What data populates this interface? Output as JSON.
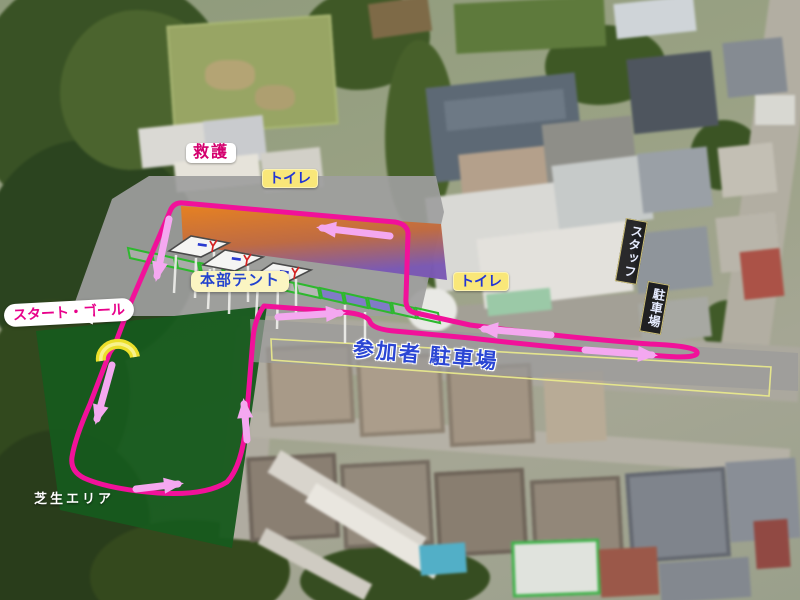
{
  "map": {
    "labels": {
      "first_aid": "救護",
      "toilet_north": "トイレ",
      "hq_tent": "本部テント",
      "toilet_school": "トイレ",
      "start_goal": "スタート・ゴール",
      "staff_parking_upper": "スタッフ",
      "staff_parking_lower": "駐車場",
      "participant_parking": "参加者 駐車場",
      "lawn_area": "芝生エリア"
    },
    "icons": {
      "start_goal_gate": "arch-gate-icon",
      "course_route": "course-route-line",
      "direction_arrow": "direction-arrow-icon",
      "hq_tents": "tent-icon"
    },
    "colors": {
      "course_line": "#f1119a",
      "direction_arrow": "#f4a8f0",
      "gate_yellow": "#ecdf2a",
      "lawn_green": "#175a1d",
      "overlay_gray": "#9e9e9e",
      "tent_zone_orange": "#e8801e",
      "tent_zone_purple": "#7a58b4",
      "parking_outline_yellow": "#e8e88c",
      "participant_text_blue": "#2b46d4",
      "label_magenta_text": "#e8008a",
      "toilet_label_bg": "#f9e779",
      "hq_label_bg": "#fbf5c2",
      "staff_sign_bg": "#08080c"
    }
  }
}
